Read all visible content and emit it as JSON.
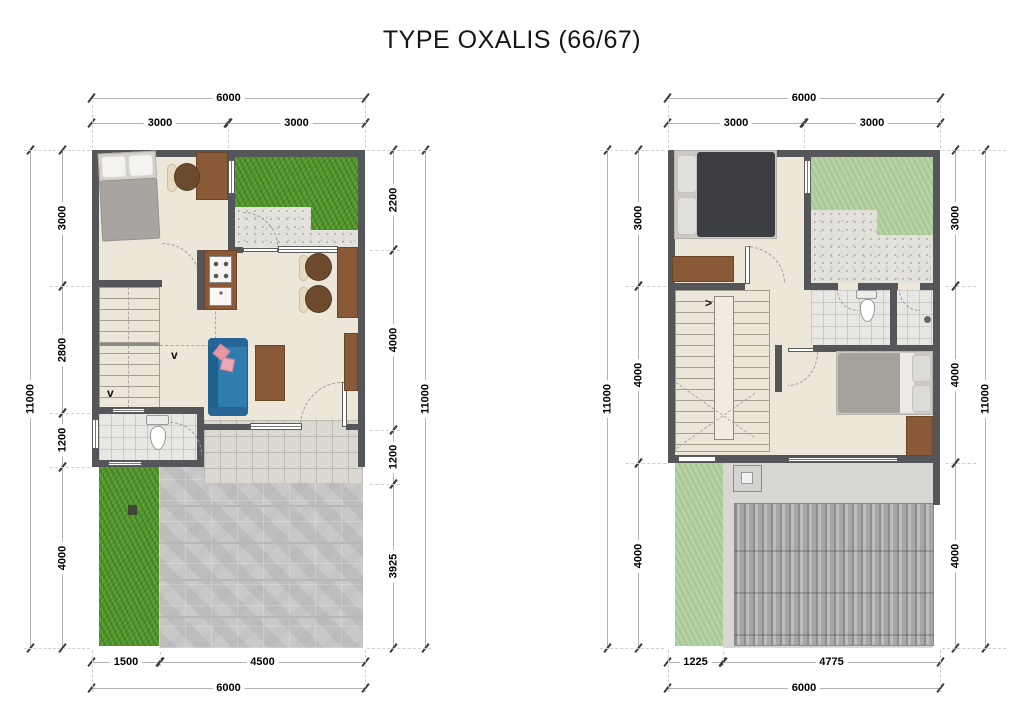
{
  "title": "TYPE OXALIS (66/67)",
  "glyphs": {
    "step_down": "v",
    "step_right": ">"
  },
  "colors": {
    "wall": "#55565a",
    "floor": "#ede7da",
    "grass_front": "#55972f",
    "grass_roof": "#b7d3a4",
    "sofa": "#2e7dae",
    "wood": "#8a5a38"
  },
  "floor1": {
    "top": {
      "total": "6000",
      "segments": [
        "3000",
        "3000"
      ]
    },
    "left": {
      "total": "11000",
      "segments": [
        "3000",
        "2800",
        "1200",
        "4000"
      ]
    },
    "right": {
      "total": "11000",
      "segments": [
        "2200",
        "4000",
        "1200",
        "3925"
      ]
    },
    "bottom": {
      "total": "6000",
      "segments": [
        "1500",
        "4500"
      ]
    }
  },
  "floor2": {
    "top": {
      "total": "6000",
      "segments": [
        "3000",
        "3000"
      ]
    },
    "left": {
      "total": "11000",
      "segments": [
        "3000",
        "4000",
        "4000"
      ]
    },
    "right": {
      "total": "11000",
      "segments": [
        "3000",
        "4000",
        "4000"
      ]
    },
    "bottom": {
      "total": "6000",
      "segments": [
        "1225",
        "4775"
      ]
    }
  }
}
